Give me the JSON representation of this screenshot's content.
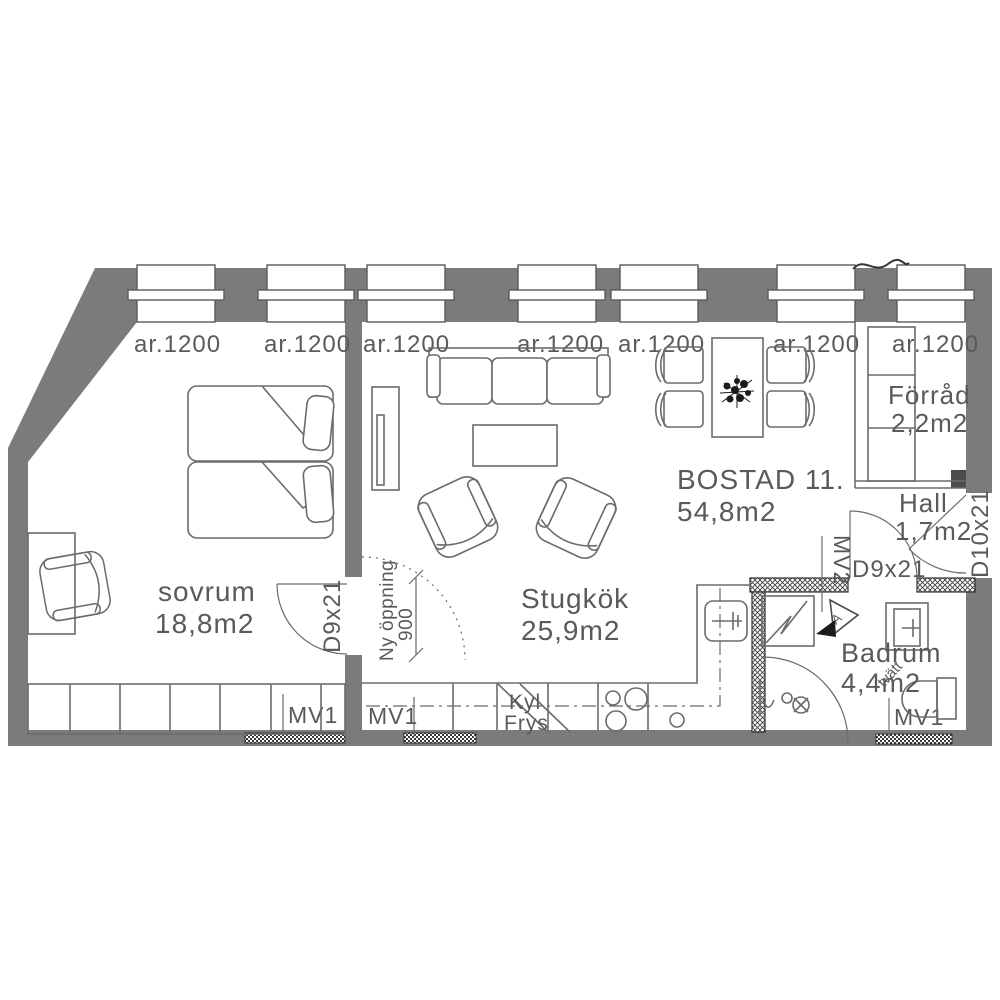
{
  "unit": {
    "label": "BOSTAD  11.",
    "area": "54,8m2"
  },
  "rooms": {
    "sovrum": {
      "name": "sovrum",
      "area": "18,8m2"
    },
    "stugkok": {
      "name": "Stugkök",
      "area": "25,9m2"
    },
    "forrad": {
      "name": "Förråd",
      "area": "2,2m2"
    },
    "hall": {
      "name": "Hall",
      "area": "1,7m2"
    },
    "badrum": {
      "name": "Badrum",
      "area": "4,4m2"
    }
  },
  "windows": {
    "label": "ar.1200",
    "count": 7
  },
  "doors": {
    "bedroom": "D9x21",
    "bathroom": "D9x21",
    "entry": "D10x21"
  },
  "vents": {
    "mv1": "MV1",
    "mv2": "MV2"
  },
  "annotations": {
    "new_opening": {
      "line1": "Ny öppning",
      "line2": "900"
    },
    "fridge": {
      "line1": "Kyl",
      "line2": "Frys"
    },
    "laundry": "tvätt",
    "section_marker": "A"
  },
  "colors": {
    "wall": "#7b7b7b",
    "hatch": "#3f3f3f",
    "line": "#6b6b6b",
    "text": "#5a5a5a",
    "background": "#ffffff"
  }
}
